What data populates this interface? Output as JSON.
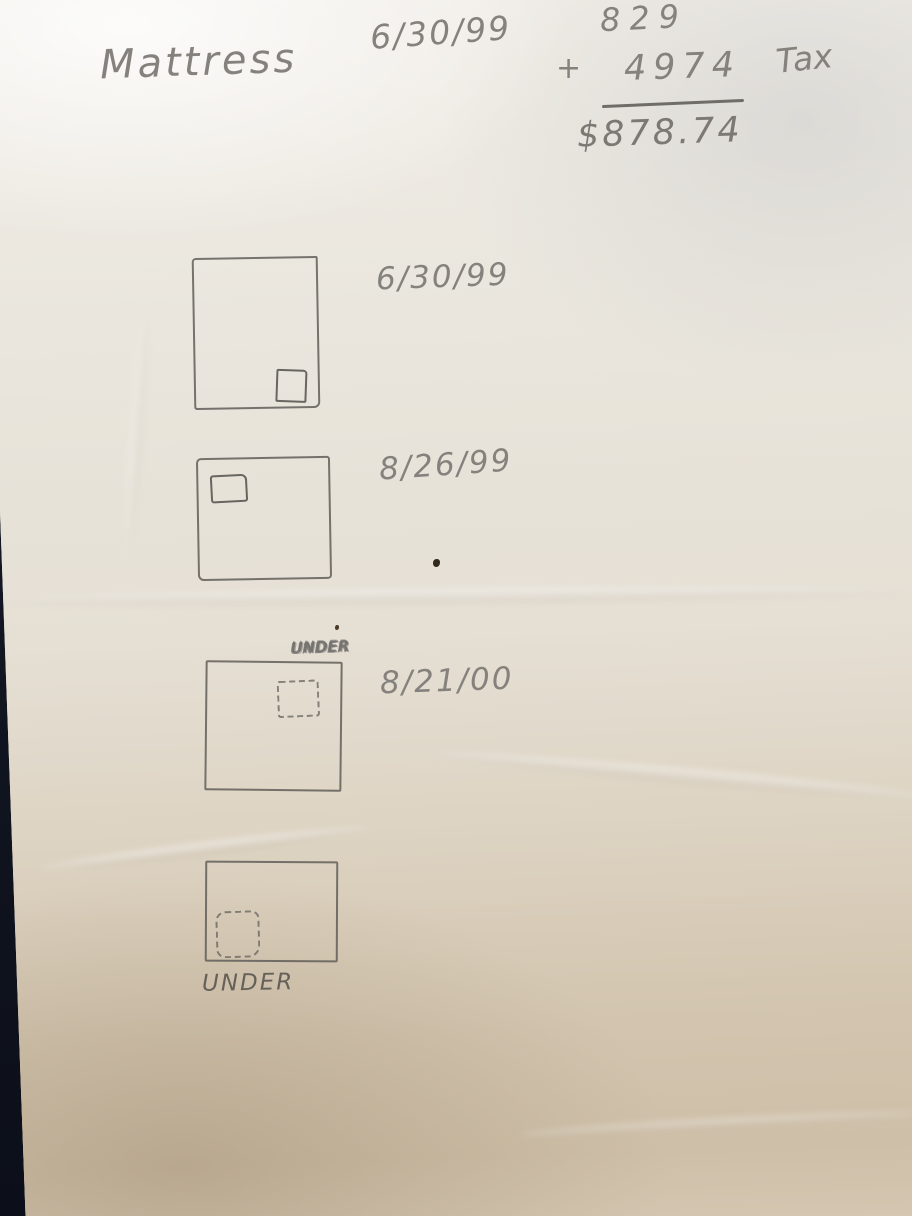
{
  "note": {
    "title": "Mattress",
    "header_date": "6/30/99",
    "calculation": {
      "price": "829",
      "operator": "+",
      "tax_value": "4974",
      "tax_label": "Tax",
      "total": "$878.74"
    },
    "entries": [
      {
        "date": "6/30/99",
        "label": "",
        "tag_corner": "bottom-right",
        "tag_outline": "solid"
      },
      {
        "date": "8/26/99",
        "label": "",
        "tag_corner": "top-left",
        "tag_outline": "solid"
      },
      {
        "date": "8/21/00",
        "label": "UNDER",
        "label_position": "above-scribbled",
        "tag_corner": "top-center",
        "tag_outline": "dashed"
      },
      {
        "date": "",
        "label": "UNDER",
        "label_position": "below",
        "tag_corner": "bottom-left",
        "tag_outline": "dashed"
      }
    ]
  }
}
